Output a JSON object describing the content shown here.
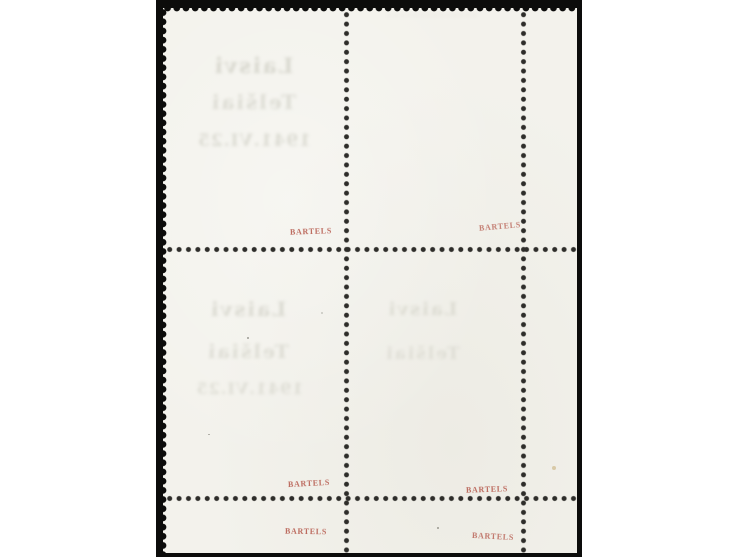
{
  "scene": {
    "subject": "reverse side of a corner block of four perforated stamps on a black backdrop",
    "colors": {
      "page_background": "#ffffff",
      "backdrop_black": "#0c0c0b",
      "stamp_paper": "#f3f2ec",
      "perforation_dot": "#2e2d2a",
      "expert_mark_red": "#b5584b",
      "offset_text_grey": "#aeae9f"
    }
  },
  "expert_marks": {
    "label": "BARTELS",
    "count": 6,
    "color": "#b5584b"
  },
  "offset_impressions": {
    "top_left": {
      "line1": "Laisvi",
      "line2": "Telšiai",
      "line3": "1941.VI.25"
    },
    "bottom_left": {
      "line1": "Laisvi",
      "line2": "Telšiai",
      "line3": "1941.VI.25"
    },
    "bottom_right": {
      "line1": "Laisvi",
      "line2": "Telšiai"
    },
    "top_right": {
      "line1": "··············"
    }
  }
}
